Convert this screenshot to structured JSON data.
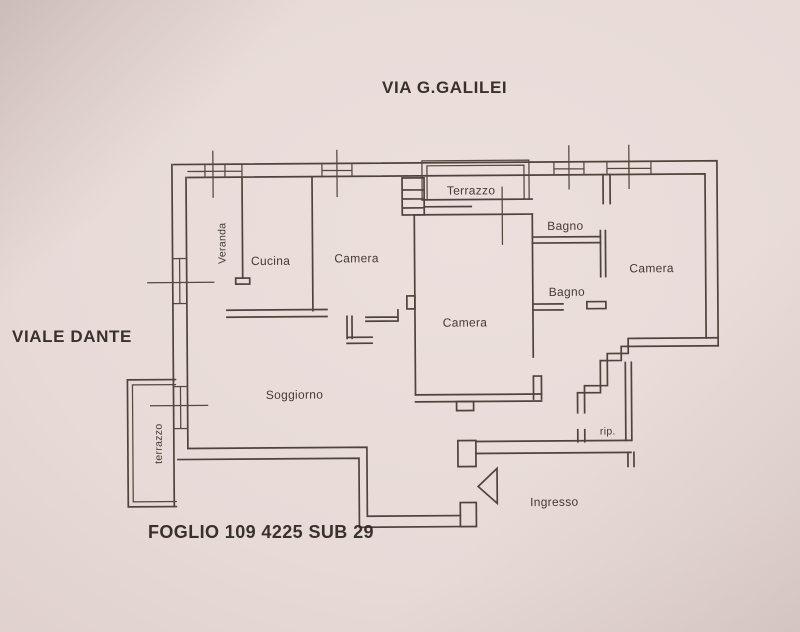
{
  "figure": {
    "kind": "cadastral floor plan photo",
    "street_top": "VIA G.GALILEI",
    "street_left": "VIALE DANTE",
    "cadastral_caption": "FOGLIO 109 4225 SUB 29"
  },
  "rooms": {
    "veranda": "Veranda",
    "cucina": "Cucina",
    "camera_left": "Camera",
    "terrazzo_top": "Terrazzo",
    "camera_center": "Camera",
    "bagno_upper": "Bagno",
    "bagno_lower": "Bagno",
    "camera_right": "Camera",
    "soggiorno": "Soggiorno",
    "terrazzo_left": "terrazzo",
    "ripostiglio": "rip.",
    "ingresso": "Ingresso"
  },
  "colors": {
    "paper": "#e7dad7",
    "paper_edge": "#d2c1bd",
    "ink": "#4f433b",
    "text": "#38302a"
  }
}
